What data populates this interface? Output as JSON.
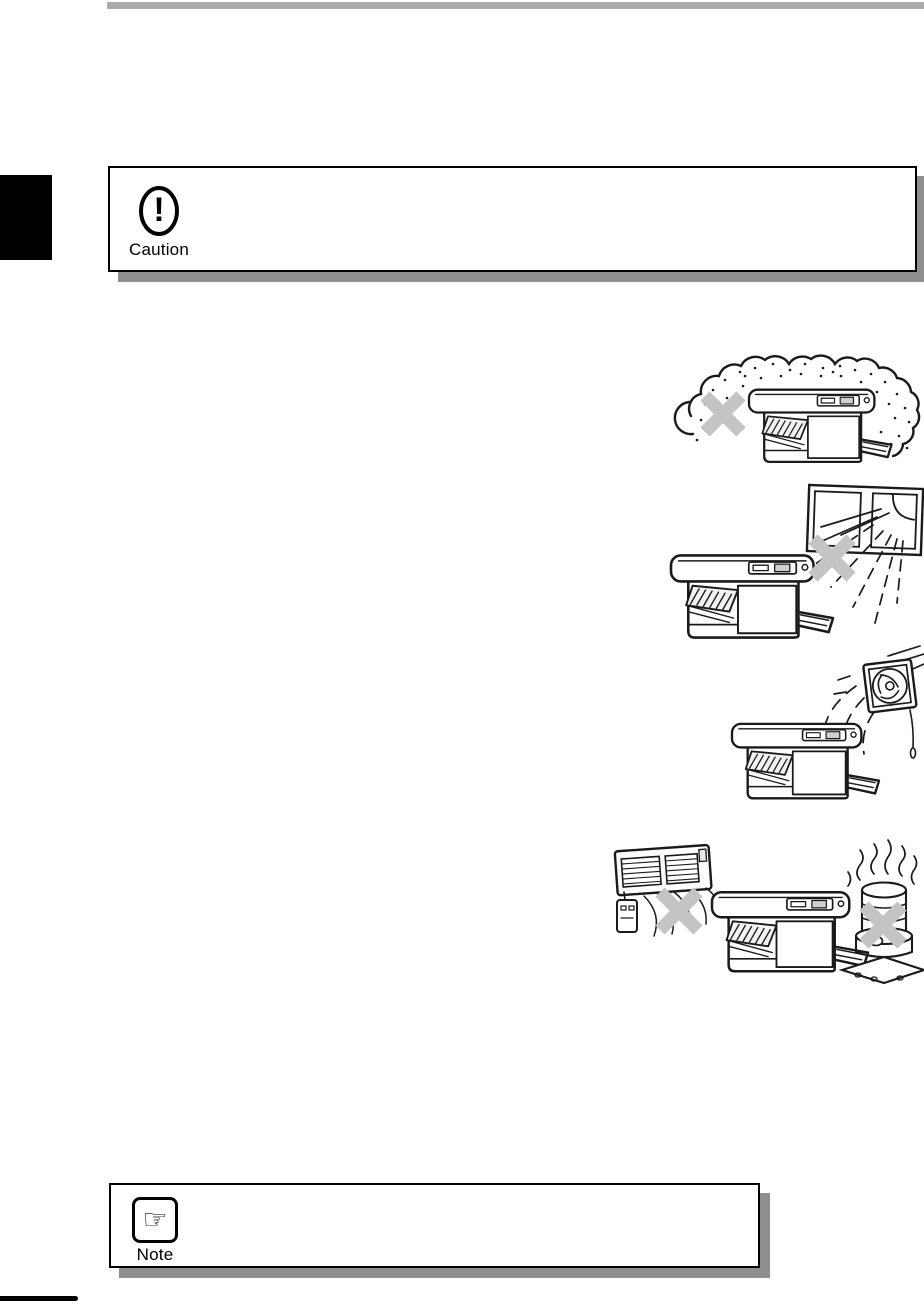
{
  "page": {
    "colors": {
      "top_bar": "#ababab",
      "side_tab": "#000000",
      "box_border": "#000000",
      "box_shadow": "#8f8f8f",
      "cross_mark": "#c4c4c4",
      "line_art": "#1a1a1a"
    }
  },
  "caution_box": {
    "label": "Caution",
    "icon": "exclamation-oval-icon",
    "icon_glyph": "!"
  },
  "note_box": {
    "label": "Note",
    "icon": "pointing-hand-icon",
    "icon_glyph": "☞"
  },
  "illustrations": [
    {
      "id": "dusty-area",
      "subject": "copier surrounded by dust cloud",
      "crossed_out": true
    },
    {
      "id": "direct-sunlight",
      "subject": "copier near window with direct sunlight",
      "crossed_out": true
    },
    {
      "id": "exhaust-fan",
      "subject": "copier in direct airflow of exhaust fan",
      "crossed_out": false
    },
    {
      "id": "heater-stove",
      "subject": "copier between wall heater and kerosene stove",
      "crossed_out": true
    }
  ]
}
